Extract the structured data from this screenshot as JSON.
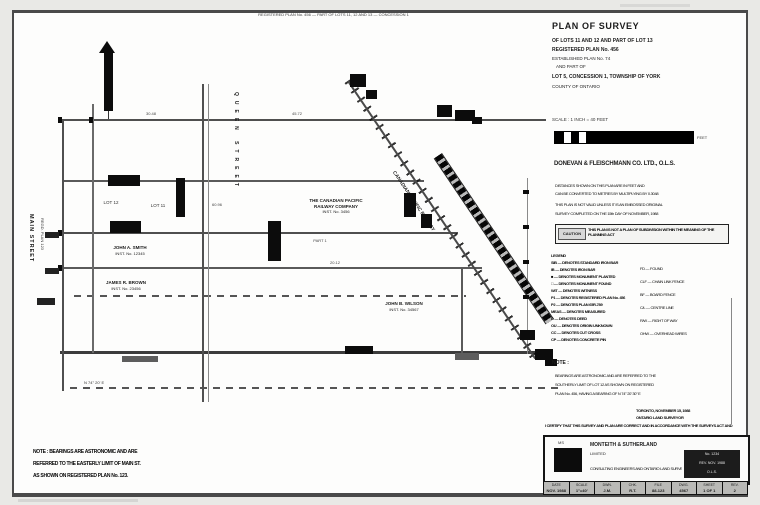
{
  "drawing": {
    "top_note": "REGISTERED PLAN No. 456 — PART OF LOTS 11, 12 AND 13 — CONCESSION 1",
    "street_left": "MAIN STREET",
    "street_left_sub": "REGD. PLAN 123",
    "street_center": "QUEEN STREET",
    "railway_label": "CANADIAN PACIFIC RAILWAY",
    "lot_a": "LOT 12",
    "lot_b": "LOT 11",
    "owner_1": [
      "JOHN A. SMITH",
      "INST. No. 12345"
    ],
    "owner_2": [
      "JAMES R. BROWN",
      "INST. No. 23456"
    ],
    "owner_3": [
      "THE CANADIAN PACIFIC",
      "RAILWAY COMPANY",
      "INST. No. 3456"
    ],
    "owner_4": [
      "JOHN B. WILSON",
      "INST. No. 34567"
    ],
    "part_label": "PART 1",
    "dim_1": "30.48",
    "dim_2": "45.72",
    "dim_3": "60.96",
    "dim_4": "20.12",
    "dim_5": "N 74° 20' E",
    "notes_block": [
      "NOTE : BEARINGS ARE ASTRONOMIC AND ARE",
      "REFERRED TO THE EASTERLY LIMIT OF MAIN ST.",
      "AS SHOWN ON REGISTERED PLAN No. 123."
    ]
  },
  "panel": {
    "title": "PLAN OF SURVEY",
    "description": [
      "OF LOTS 11 AND 12 AND PART OF LOT 13",
      "REGISTERED PLAN No. 456",
      "ESTABLISHED PLAN No. 74",
      "AND PART OF",
      "LOT 5, CONCESSION 1, TOWNSHIP OF YORK",
      "COUNTY OF ONTARIO"
    ],
    "scale_text": "SCALE : 1 INCH = 40 FEET",
    "scale_unit": "FEET",
    "firm_line": "DONEVAN & FLEISCHMANN CO. LTD., O.L.S.",
    "notes_a": [
      "DISTANCES SHOWN ON THIS PLAN ARE IN FEET AND",
      "CAN BE CONVERTED TO METRES BY MULTIPLYING BY 0.3048",
      "THIS PLAN IS NOT VALID UNLESS IT IS AN EMBOSSED ORIGINAL",
      "SURVEY COMPLETED ON THE 15th DAY OF NOVEMBER, 1988"
    ],
    "caution": {
      "label": "CAUTION",
      "text": "THIS PLAN IS NOT A PLAN OF SUBDIVISION WITHIN THE MEANING OF THE PLANNING ACT"
    },
    "legend_left": [
      "LEGEND",
      "SIB — DENOTES STANDARD IRON BAR",
      "IB — DENOTES IRON BAR",
      "■ — DENOTES MONUMENT PLANTED",
      "□ — DENOTES MONUMENT FOUND",
      "WIT — DENOTES WITNESS",
      "P1 — DENOTES REGISTERED PLAN No. 456",
      "P2 — DENOTES PLAN 65R-789",
      "MEAS — DENOTES MEASURED",
      "D — DENOTES DEED",
      "OU — DENOTES ORIGIN UNKNOWN",
      "CC — DENOTES CUT CROSS",
      "CP — DENOTES CONCRETE PIN"
    ],
    "legend_right": [
      "FD — FOUND",
      "CLF — CHAIN LINK FENCE",
      "BF — BOARD FENCE",
      "C/L — CENTRE LINE",
      "R/W — RIGHT OF WAY",
      "OHW — OVERHEAD WIRES"
    ],
    "bearing_title": "NOTE :",
    "bearing_note": [
      "BEARINGS ARE ASTRONOMIC AND ARE REFERRED TO THE",
      "SOUTHERLY LIMIT OF LOT 12 AS SHOWN ON REGISTERED",
      "PLAN No. 456, HAVING A BEARING OF N 74° 20' 30\" E"
    ],
    "cert_sign": [
      "TORONTO, NOVEMBER 15, 1988",
      "ONTARIO LAND SURVEYOR"
    ],
    "cert_bar": "I CERTIFY THAT THIS SURVEY AND PLAN ARE CORRECT AND IN ACCORDANCE WITH THE SURVEYS ACT AND THE REGISTRY ACT",
    "title_block": {
      "logo_text": "MS",
      "firm_name": "MONTEITH & SUTHERLAND",
      "firm_sub": "LIMITED",
      "firm_desc": "CONSULTING ENGINEERS AND ONTARIO LAND SURVEYORS",
      "stamp": [
        "No. 1234",
        "REV. NOV. 1988",
        "O.L.S."
      ],
      "fields": [
        {
          "label": "DATE",
          "value": "NOV. 1988"
        },
        {
          "label": "SCALE",
          "value": "1\"=40'"
        },
        {
          "label": "DWN.",
          "value": "J.M."
        },
        {
          "label": "CHK.",
          "value": "R.T."
        },
        {
          "label": "FILE",
          "value": "88-123"
        },
        {
          "label": "DWG.",
          "value": "4567"
        },
        {
          "label": "SHEET",
          "value": "1 OF 1"
        },
        {
          "label": "REV.",
          "value": "2"
        }
      ]
    }
  }
}
